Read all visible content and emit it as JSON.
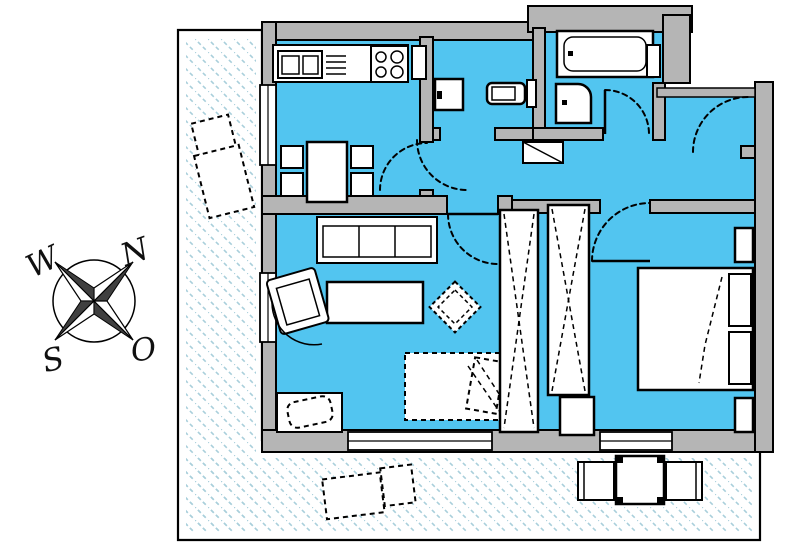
{
  "compass": {
    "north_label": "N",
    "west_label": "W",
    "south_label": "S",
    "east_label": "O"
  },
  "colors": {
    "floor": "#52c5f0",
    "wall": "#b5b5b5",
    "outline": "#000000",
    "hatch": "#a9cfdb",
    "paper": "#ffffff",
    "star_dark": "#3f3f3f"
  },
  "symbols": [
    "compass-rose",
    "terrace",
    "sun-lounger",
    "patio-table",
    "patio-chair",
    "kitchen-counter",
    "sink",
    "dish-rack",
    "stove",
    "tall-cabinet",
    "dining-table",
    "dining-chair",
    "washbasin",
    "toilet",
    "bathtub",
    "shower",
    "bathroom-shelf",
    "hall-cabinet",
    "sofa",
    "coffee-table",
    "armchair",
    "side-table",
    "guest-bed",
    "tv-board",
    "tv",
    "wardrobe",
    "dresser",
    "double-bed",
    "pillow",
    "nightstand",
    "door-swing",
    "window",
    "wall"
  ]
}
